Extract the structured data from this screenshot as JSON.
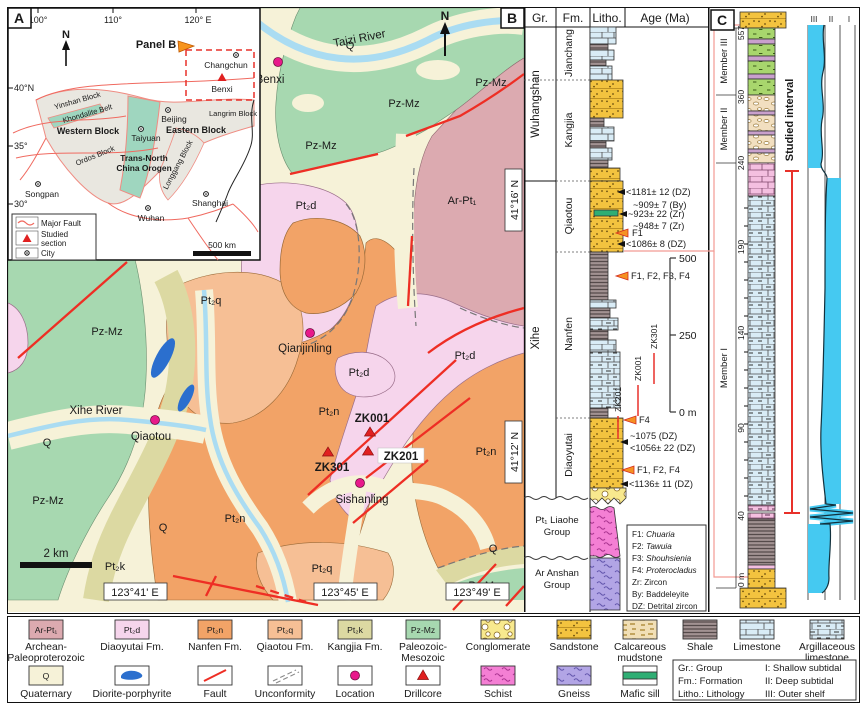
{
  "colors": {
    "fault_red": "#ee2e24",
    "location_magenta": "#e8198b",
    "facies_cyan": "#45c9f1",
    "studied_red": "#e8312a",
    "connector_pink": "#f29a93",
    "pzmz_green": "#a7d8b0",
    "arpt1_rose": "#dcaab0",
    "pt2d_pink": "#f6d5ec",
    "pt2n_orange": "#f2a367",
    "pt2q_orange": "#f6bf95",
    "pt2k_olive": "#dcd9a2",
    "quaternary_cream": "#f6f2d8",
    "diorite_blue": "#2b6fce"
  },
  "panel_a": {
    "label": "A",
    "north": "N",
    "callout": "Panel B",
    "top_ticks": [
      "100°",
      "110°",
      "120° E"
    ],
    "left_ticks": [
      "40°N",
      "35°",
      "30°"
    ],
    "blocks": {
      "yinshan": "Yinshan Block",
      "khondalite": "Khondalite Belt",
      "western": "Western Block",
      "ordos": "Ordos Block",
      "tnco1": "Trans-North",
      "tnco2": "China Orogen",
      "eastern": "Eastern Block",
      "longgang": "Longgang Block",
      "langrim": "Langrim Block"
    },
    "cities": {
      "changchun": "Changchun",
      "benxi": "Benxi",
      "beijing": "Beijing",
      "taiyuan": "Taiyuan",
      "songpan": "Songpan",
      "wuhan": "Wuhan",
      "shanghai": "Shanghai"
    },
    "legend": {
      "fault": "Major Fault",
      "section1": "Studied",
      "section2": "section",
      "city": "City"
    },
    "scale": "500 km"
  },
  "panel_b": {
    "label": "B",
    "north": "N",
    "rivers": {
      "taizi": "Taizi River",
      "xihe": "Xihe River"
    },
    "towns": {
      "benxi": "Benxi",
      "qiaotou": "Qiaotou",
      "qianjinling": "Qianjinling",
      "sishanling": "Sishanling"
    },
    "drillcores": {
      "zk001": "ZK001",
      "zk301": "ZK301",
      "zk201": "ZK201"
    },
    "units": {
      "q": "Q",
      "pzmz": "Pz-Mz",
      "arpt1": "Ar-Pt₁",
      "pt2d": "Pt₂d",
      "pt2n": "Pt₂n",
      "pt2q": "Pt₂q",
      "pt2k": "Pt₂k"
    },
    "lon": [
      "123°41' E",
      "123°45' E",
      "123°49' E"
    ],
    "lat": [
      "41°16' N",
      "41°12' N"
    ],
    "scale": "2 km"
  },
  "column": {
    "headers": [
      "Gr.",
      "Fm.",
      "Litho.",
      "Age (Ma)"
    ],
    "groups": [
      "Wuhangshan",
      "Xihe"
    ],
    "liaohe1": "Pt₁ Liaohe",
    "liaohe2": "Group",
    "anshan1": "Ar Anshan",
    "anshan2": "Group",
    "formations": [
      "Jianchang",
      "Kangjia",
      "Qiaotou",
      "Nanfen",
      "Diaoyutai"
    ],
    "ages": {
      "a1": "<1181± 12 (DZ)",
      "a2": "~909± 7 (By)",
      "a3": "~923± 22 (Zr)",
      "a4": "~948± 7 (Zr)",
      "a5": "F1",
      "a6": "<1086± 8 (DZ)",
      "a7": "F1, F2, F3, F4",
      "a8": "F4",
      "a9": "~1075 (DZ)",
      "a10": "<1056± 22 (DZ)",
      "a11": "F1, F2, F4",
      "a12": "<1136± 11 (DZ)"
    },
    "scale_ticks": [
      "500",
      "250",
      "0 m"
    ],
    "drills": [
      "ZK301",
      "ZK001",
      "ZK201"
    ],
    "fossil_key": [
      {
        "code": "F1:",
        "name": "Chuaria"
      },
      {
        "code": "F2:",
        "name": "Tawuia"
      },
      {
        "code": "F3:",
        "name": "Shouhsienia"
      },
      {
        "code": "F4:",
        "name": "Proterocladus"
      },
      {
        "code": "Zr:",
        "name": "Zircon"
      },
      {
        "code": "By:",
        "name": "Baddeleyite"
      },
      {
        "code": "DZ:",
        "name": "Detrital zircon"
      }
    ]
  },
  "panel_c": {
    "label": "C",
    "members": [
      "Member III",
      "Member II",
      "Member I"
    ],
    "depths": [
      "557",
      "360",
      "240",
      "190",
      "140",
      "90",
      "40",
      "0 m"
    ],
    "studied_interval": "Studied interval",
    "facies_ticks": [
      "III",
      "II",
      "I"
    ]
  },
  "legend": {
    "row1": [
      {
        "chip": "Ar-Pt₁",
        "label1": "Archean-",
        "label2": "Paleoproterozoic"
      },
      {
        "chip": "Pt₂d",
        "label1": "Diaoyutai Fm."
      },
      {
        "chip": "Pt₂n",
        "label1": "Nanfen Fm."
      },
      {
        "chip": "Pt₂q",
        "label1": "Qiaotou Fm."
      },
      {
        "chip": "Pt₂k",
        "label1": "Kangjia Fm."
      },
      {
        "chip": "Pz-Mz",
        "label1": "Paleozoic-",
        "label2": "Mesozoic"
      },
      {
        "label1": "Conglomerate"
      },
      {
        "label1": "Sandstone"
      },
      {
        "label1": "Calcareous",
        "label2": "mudstone"
      },
      {
        "label1": "Shale"
      },
      {
        "label1": "Limestone"
      },
      {
        "label1": "Argillaceous",
        "label2": "limestone"
      }
    ],
    "row2": [
      {
        "chip": "Q",
        "label1": "Quaternary"
      },
      {
        "label1": "Diorite-porphyrite"
      },
      {
        "label1": "Fault"
      },
      {
        "label1": "Unconformity"
      },
      {
        "label1": "Location"
      },
      {
        "label1": "Drillcore"
      },
      {
        "label1": "Schist"
      },
      {
        "label1": "Gneiss"
      },
      {
        "label1": "Mafic sill"
      }
    ],
    "info": {
      "l1": "Gr.: Group",
      "l2": "Fm.: Formation",
      "l3": "Litho.: Lithology",
      "r1": "I: Shallow subtidal",
      "r2": "II: Deep subtidal",
      "r3": "III: Outer shelf"
    }
  }
}
